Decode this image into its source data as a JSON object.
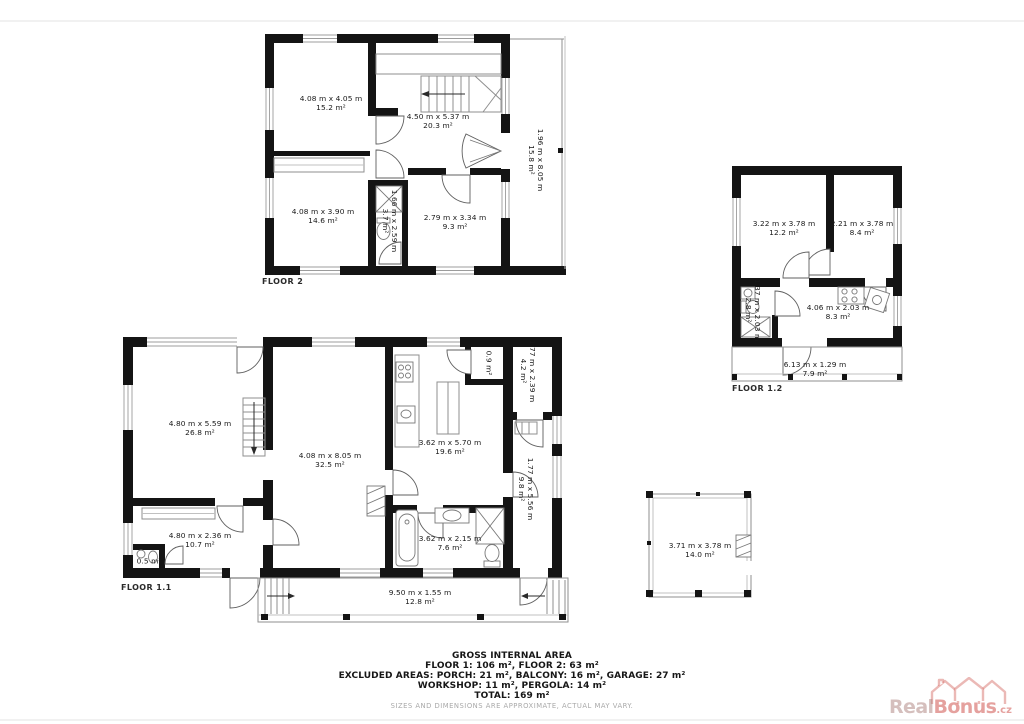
{
  "floors": {
    "floor2": {
      "label": "FLOOR 2",
      "rooms": [
        {
          "dim": "4.08 m x 4.05 m",
          "area": "15.2 m²"
        },
        {
          "dim": "4.50 m x 5.37 m",
          "area": "20.3 m²"
        },
        {
          "dim": "1.96 m x 8.05 m",
          "area": "15.8 m²"
        },
        {
          "dim": "4.08 m x 3.90 m",
          "area": "14.6 m²"
        },
        {
          "dim": "1.66 m x 2.59 m",
          "area": "3.7 m²"
        },
        {
          "dim": "2.79 m x 3.34 m",
          "area": "9.3 m²"
        }
      ]
    },
    "floor12": {
      "label": "FLOOR 1.2",
      "rooms": [
        {
          "dim": "3.22 m x 3.78 m",
          "area": "12.2 m²"
        },
        {
          "dim": "2.21 m x 3.78 m",
          "area": "8.4 m²"
        },
        {
          "dim": "1.37 m x 2.03 m",
          "area": "2.8 m²"
        },
        {
          "dim": "4.06 m x 2.03 m",
          "area": "8.3 m²"
        },
        {
          "dim": "6.13 m x 1.29 m",
          "area": "7.9 m²"
        }
      ]
    },
    "floor11": {
      "label": "FLOOR 1.1",
      "rooms": [
        {
          "dim": "4.80 m x 5.59 m",
          "area": "26.8 m²"
        },
        {
          "dim": "4.08 m x 8.05 m",
          "area": "32.5 m²"
        },
        {
          "dim": "3.62 m x 5.70 m",
          "area": "19.6 m²"
        },
        {
          "dim": "",
          "area": "0.9 m²"
        },
        {
          "dim": "1.77 m x 2.39 m",
          "area": "4.2 m²"
        },
        {
          "dim": "1.77 m x 5.56 m",
          "area": "9.8 m²"
        },
        {
          "dim": "4.80 m x 2.36 m",
          "area": "10.7 m²"
        },
        {
          "dim": "",
          "area": "0.5 m²"
        },
        {
          "dim": "3.62 m x 2.15 m",
          "area": "7.6 m²"
        },
        {
          "dim": "9.50 m x 1.55 m",
          "area": "12.8 m²"
        }
      ]
    },
    "pergola": {
      "rooms": [
        {
          "dim": "3.71 m x 3.78 m",
          "area": "14.0 m²"
        }
      ]
    }
  },
  "summary": {
    "title": "GROSS INTERNAL AREA",
    "line1": "FLOOR 1: 106 m², FLOOR 2: 63 m²",
    "line2": "EXCLUDED AREAS: PORCH: 21 m², BALCONY: 16 m², GARAGE: 27 m²",
    "line3": "WORKSHOP: 11 m², PERGOLA: 14 m²",
    "line4": "TOTAL: 169 m²",
    "disclaimer": "SIZES AND DIMENSIONS ARE APPROXIMATE, ACTUAL MAY VARY."
  },
  "watermark": {
    "real": "Real",
    "bonus": "Bonus",
    "tld": ".cz"
  },
  "colors": {
    "wall": "#141414",
    "thin_line": "#8f8f8f",
    "label_text": "#181818",
    "disclaimer": "#a9a9a9",
    "watermark_light": "rgba(172,128,124,0.50)",
    "watermark_strong": "rgba(213,104,98,0.62)"
  }
}
